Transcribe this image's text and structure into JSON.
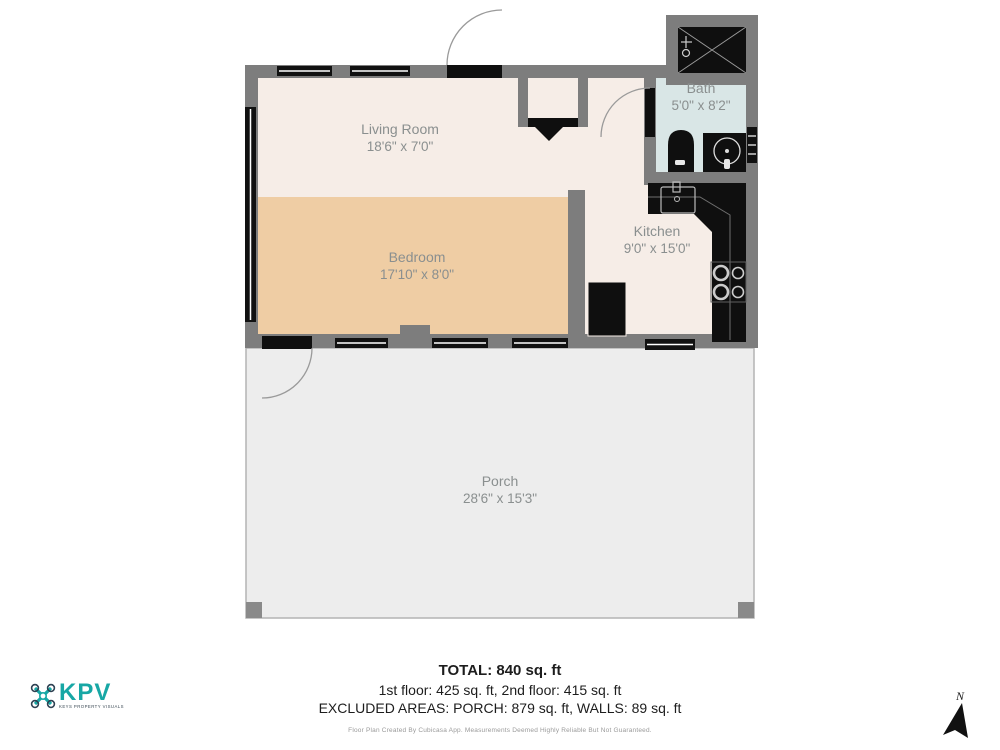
{
  "title": "Floor plan",
  "rooms": [
    {
      "name": "Living Room",
      "dims": "18'6\" x 7'0\""
    },
    {
      "name": "Bedroom",
      "dims": "17'10\" x 8'0\""
    },
    {
      "name": "Kitchen",
      "dims": "9'0\" x 15'0\""
    },
    {
      "name": "Bath",
      "dims": "5'0\" x 8'2\""
    },
    {
      "name": "Porch",
      "dims": "28'6\" x 15'3\""
    }
  ],
  "summary": {
    "total": "TOTAL: 840 sq. ft",
    "floors": "1st floor: 425 sq. ft, 2nd floor: 415 sq. ft",
    "excluded": "EXCLUDED AREAS: PORCH: 879 sq. ft, WALLS: 89 sq. ft",
    "disclaimer": "Floor Plan Created By Cubicasa App. Measurements Deemed Highly Reliable But Not Guaranteed."
  },
  "logo": {
    "name": "KPV",
    "tagline": "KEYS PROPERTY VISUALS"
  },
  "compass": {
    "label": "N"
  },
  "icons": [
    "kpv-drone-icon",
    "north-arrow-icon",
    "entrance-arrow-icon",
    "shower-head-icon"
  ],
  "colors": {
    "wall": "#7d7d7d",
    "floor_main": "#f6ede7",
    "floor_bedroom": "#efcda4",
    "floor_bath": "#d9e6e6",
    "floor_porch": "#ededed",
    "fixture_black": "#0f0f0f",
    "logo_teal": "#17a7a5",
    "label_gray": "#8a8f8f"
  }
}
